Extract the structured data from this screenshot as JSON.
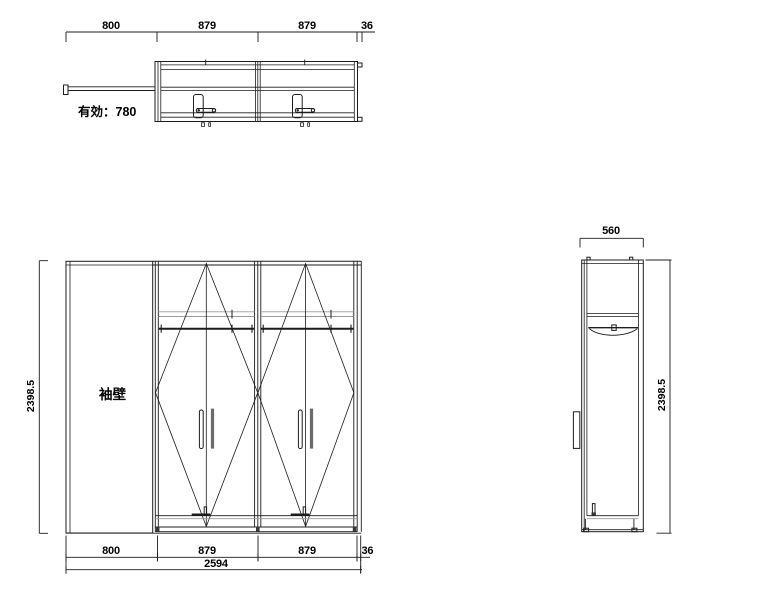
{
  "plan": {
    "dims": [
      "800",
      "879",
      "879",
      "36"
    ],
    "effective": "有効：780"
  },
  "front": {
    "wall_label": "袖壁",
    "height": "2398.5",
    "dims": [
      "800",
      "879",
      "879",
      "36"
    ],
    "total": "2594"
  },
  "side": {
    "width": "560",
    "height": "2398.5"
  },
  "colors": {
    "line": "#1c1c1c",
    "light_line": "#9b9b9b",
    "background": "#ffffff"
  }
}
